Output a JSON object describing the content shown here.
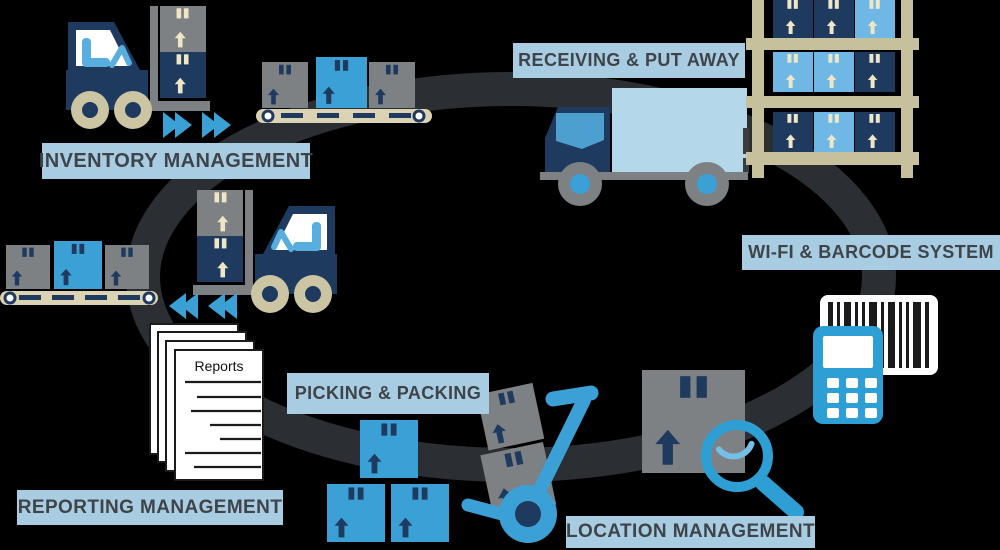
{
  "title": "Warehouse Management System Cycle",
  "stages": [
    {
      "id": "inventory-management",
      "label": "INVENTORY MANAGEMENT",
      "icon": "forklift-icon"
    },
    {
      "id": "receiving-put-away",
      "label": "RECEIVING & PUT AWAY",
      "icon": "delivery-truck-icon"
    },
    {
      "id": "wifi-barcode-system",
      "label": "WI-FI & BARCODE SYSTEM",
      "icon": "barcode-scanner-icon"
    },
    {
      "id": "picking-packing",
      "label": "PICKING & PACKING",
      "icon": "package-pyramid-icon"
    },
    {
      "id": "location-management",
      "label": "LOCATION MANAGEMENT",
      "icon": "magnifier-icon"
    },
    {
      "id": "reporting-management",
      "label": "REPORTING MANAGEMENT",
      "icon": "reports-document-icon"
    }
  ],
  "document": {
    "title": "Reports"
  },
  "icons": [
    "forklift-icon",
    "conveyor-icon",
    "delivery-truck-icon",
    "warehouse-shelf-icon",
    "barcode-card-icon",
    "barcode-scanner-icon",
    "package-box-icon",
    "magnifier-icon",
    "hand-truck-icon",
    "package-pyramid-icon",
    "reports-document-icon",
    "forward-arrows-icon",
    "back-arrows-icon",
    "cycle-ring"
  ],
  "colors": {
    "background": "#000000",
    "cycle_ring": "#2B2F33",
    "label_background": "#A8CDE3",
    "label_text": "#3F4448",
    "navy": "#1F3A5F",
    "blue": "#3BA0D6",
    "light_blue": "#6FB7E4",
    "truck_cargo": "#B5D7EA",
    "gray": "#7E8184",
    "wheel_tan": "#CBC5A3",
    "conveyor_tan": "#DBD3B4",
    "shelf_tan": "#C6C09C",
    "tape_cream": "#EFE6C6",
    "scanner_blue": "#2E9FD4",
    "page_white": "#FFFFFF"
  }
}
